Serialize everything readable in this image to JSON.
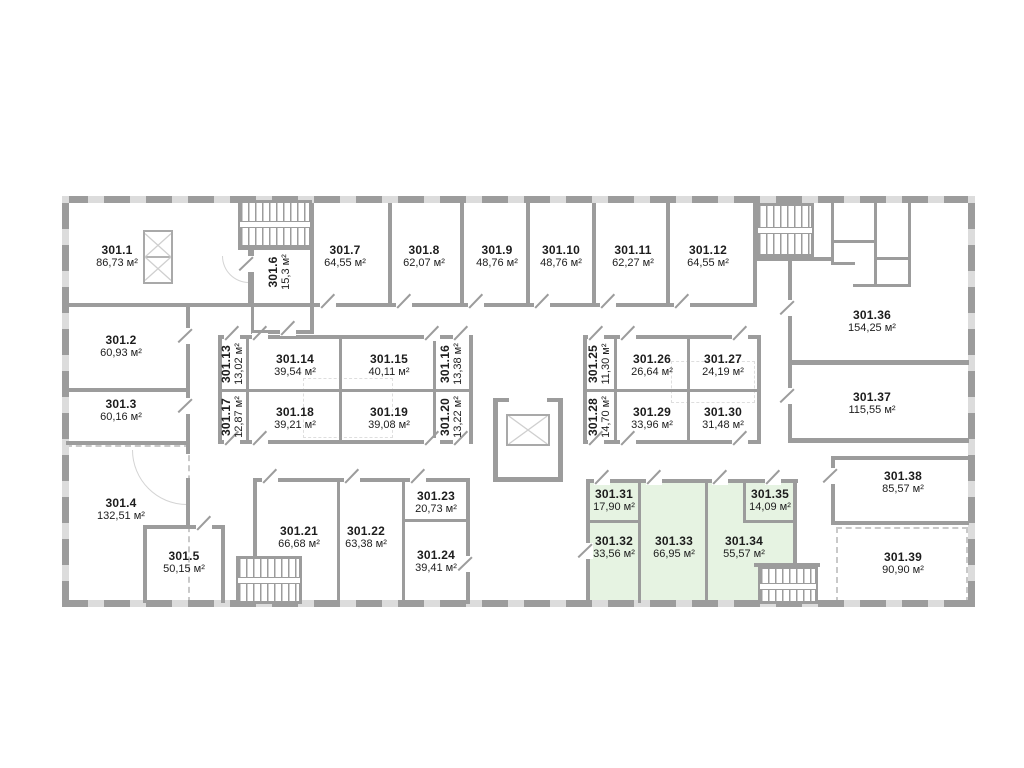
{
  "units": "м²",
  "colors": {
    "highlight_green": "#e6f3e2",
    "wall_gray": "#9c9c9c"
  },
  "highlighted_rooms": [
    "301.31",
    "301.32",
    "301.33",
    "301.34",
    "301.35"
  ],
  "rooms": [
    {
      "id": "301.1",
      "area": "86,73 м²"
    },
    {
      "id": "301.2",
      "area": "60,93 м²"
    },
    {
      "id": "301.3",
      "area": "60,16 м²"
    },
    {
      "id": "301.4",
      "area": "132,51 м²"
    },
    {
      "id": "301.5",
      "area": "50,15 м²"
    },
    {
      "id": "301.6",
      "area": "15,3 м²"
    },
    {
      "id": "301.7",
      "area": "64,55 м²"
    },
    {
      "id": "301.8",
      "area": "62,07 м²"
    },
    {
      "id": "301.9",
      "area": "48,76 м²"
    },
    {
      "id": "301.10",
      "area": "48,76 м²"
    },
    {
      "id": "301.11",
      "area": "62,27 м²"
    },
    {
      "id": "301.12",
      "area": "64,55 м²"
    },
    {
      "id": "301.13",
      "area": "13,02 м²"
    },
    {
      "id": "301.14",
      "area": "39,54 м²"
    },
    {
      "id": "301.15",
      "area": "40,11 м²"
    },
    {
      "id": "301.16",
      "area": "13,38 м²"
    },
    {
      "id": "301.17",
      "area": "12,87 м²"
    },
    {
      "id": "301.18",
      "area": "39,21 м²"
    },
    {
      "id": "301.19",
      "area": "39,08 м²"
    },
    {
      "id": "301.20",
      "area": "13,22 м²"
    },
    {
      "id": "301.21",
      "area": "66,68 м²"
    },
    {
      "id": "301.22",
      "area": "63,38 м²"
    },
    {
      "id": "301.23",
      "area": "20,73 м²"
    },
    {
      "id": "301.24",
      "area": "39,41 м²"
    },
    {
      "id": "301.25",
      "area": "11,30 м²"
    },
    {
      "id": "301.26",
      "area": "26,64 м²"
    },
    {
      "id": "301.27",
      "area": "24,19 м²"
    },
    {
      "id": "301.28",
      "area": "14,70 м²"
    },
    {
      "id": "301.29",
      "area": "33,96 м²"
    },
    {
      "id": "301.30",
      "area": "31,48 м²"
    },
    {
      "id": "301.31",
      "area": "17,90 м²"
    },
    {
      "id": "301.32",
      "area": "33,56 м²"
    },
    {
      "id": "301.33",
      "area": "66,95 м²"
    },
    {
      "id": "301.34",
      "area": "55,57 м²"
    },
    {
      "id": "301.35",
      "area": "14,09 м²"
    },
    {
      "id": "301.36",
      "area": "154,25 м²"
    },
    {
      "id": "301.37",
      "area": "115,55 м²"
    },
    {
      "id": "301.38",
      "area": "85,57 м²"
    },
    {
      "id": "301.39",
      "area": "90,90 м²"
    }
  ]
}
